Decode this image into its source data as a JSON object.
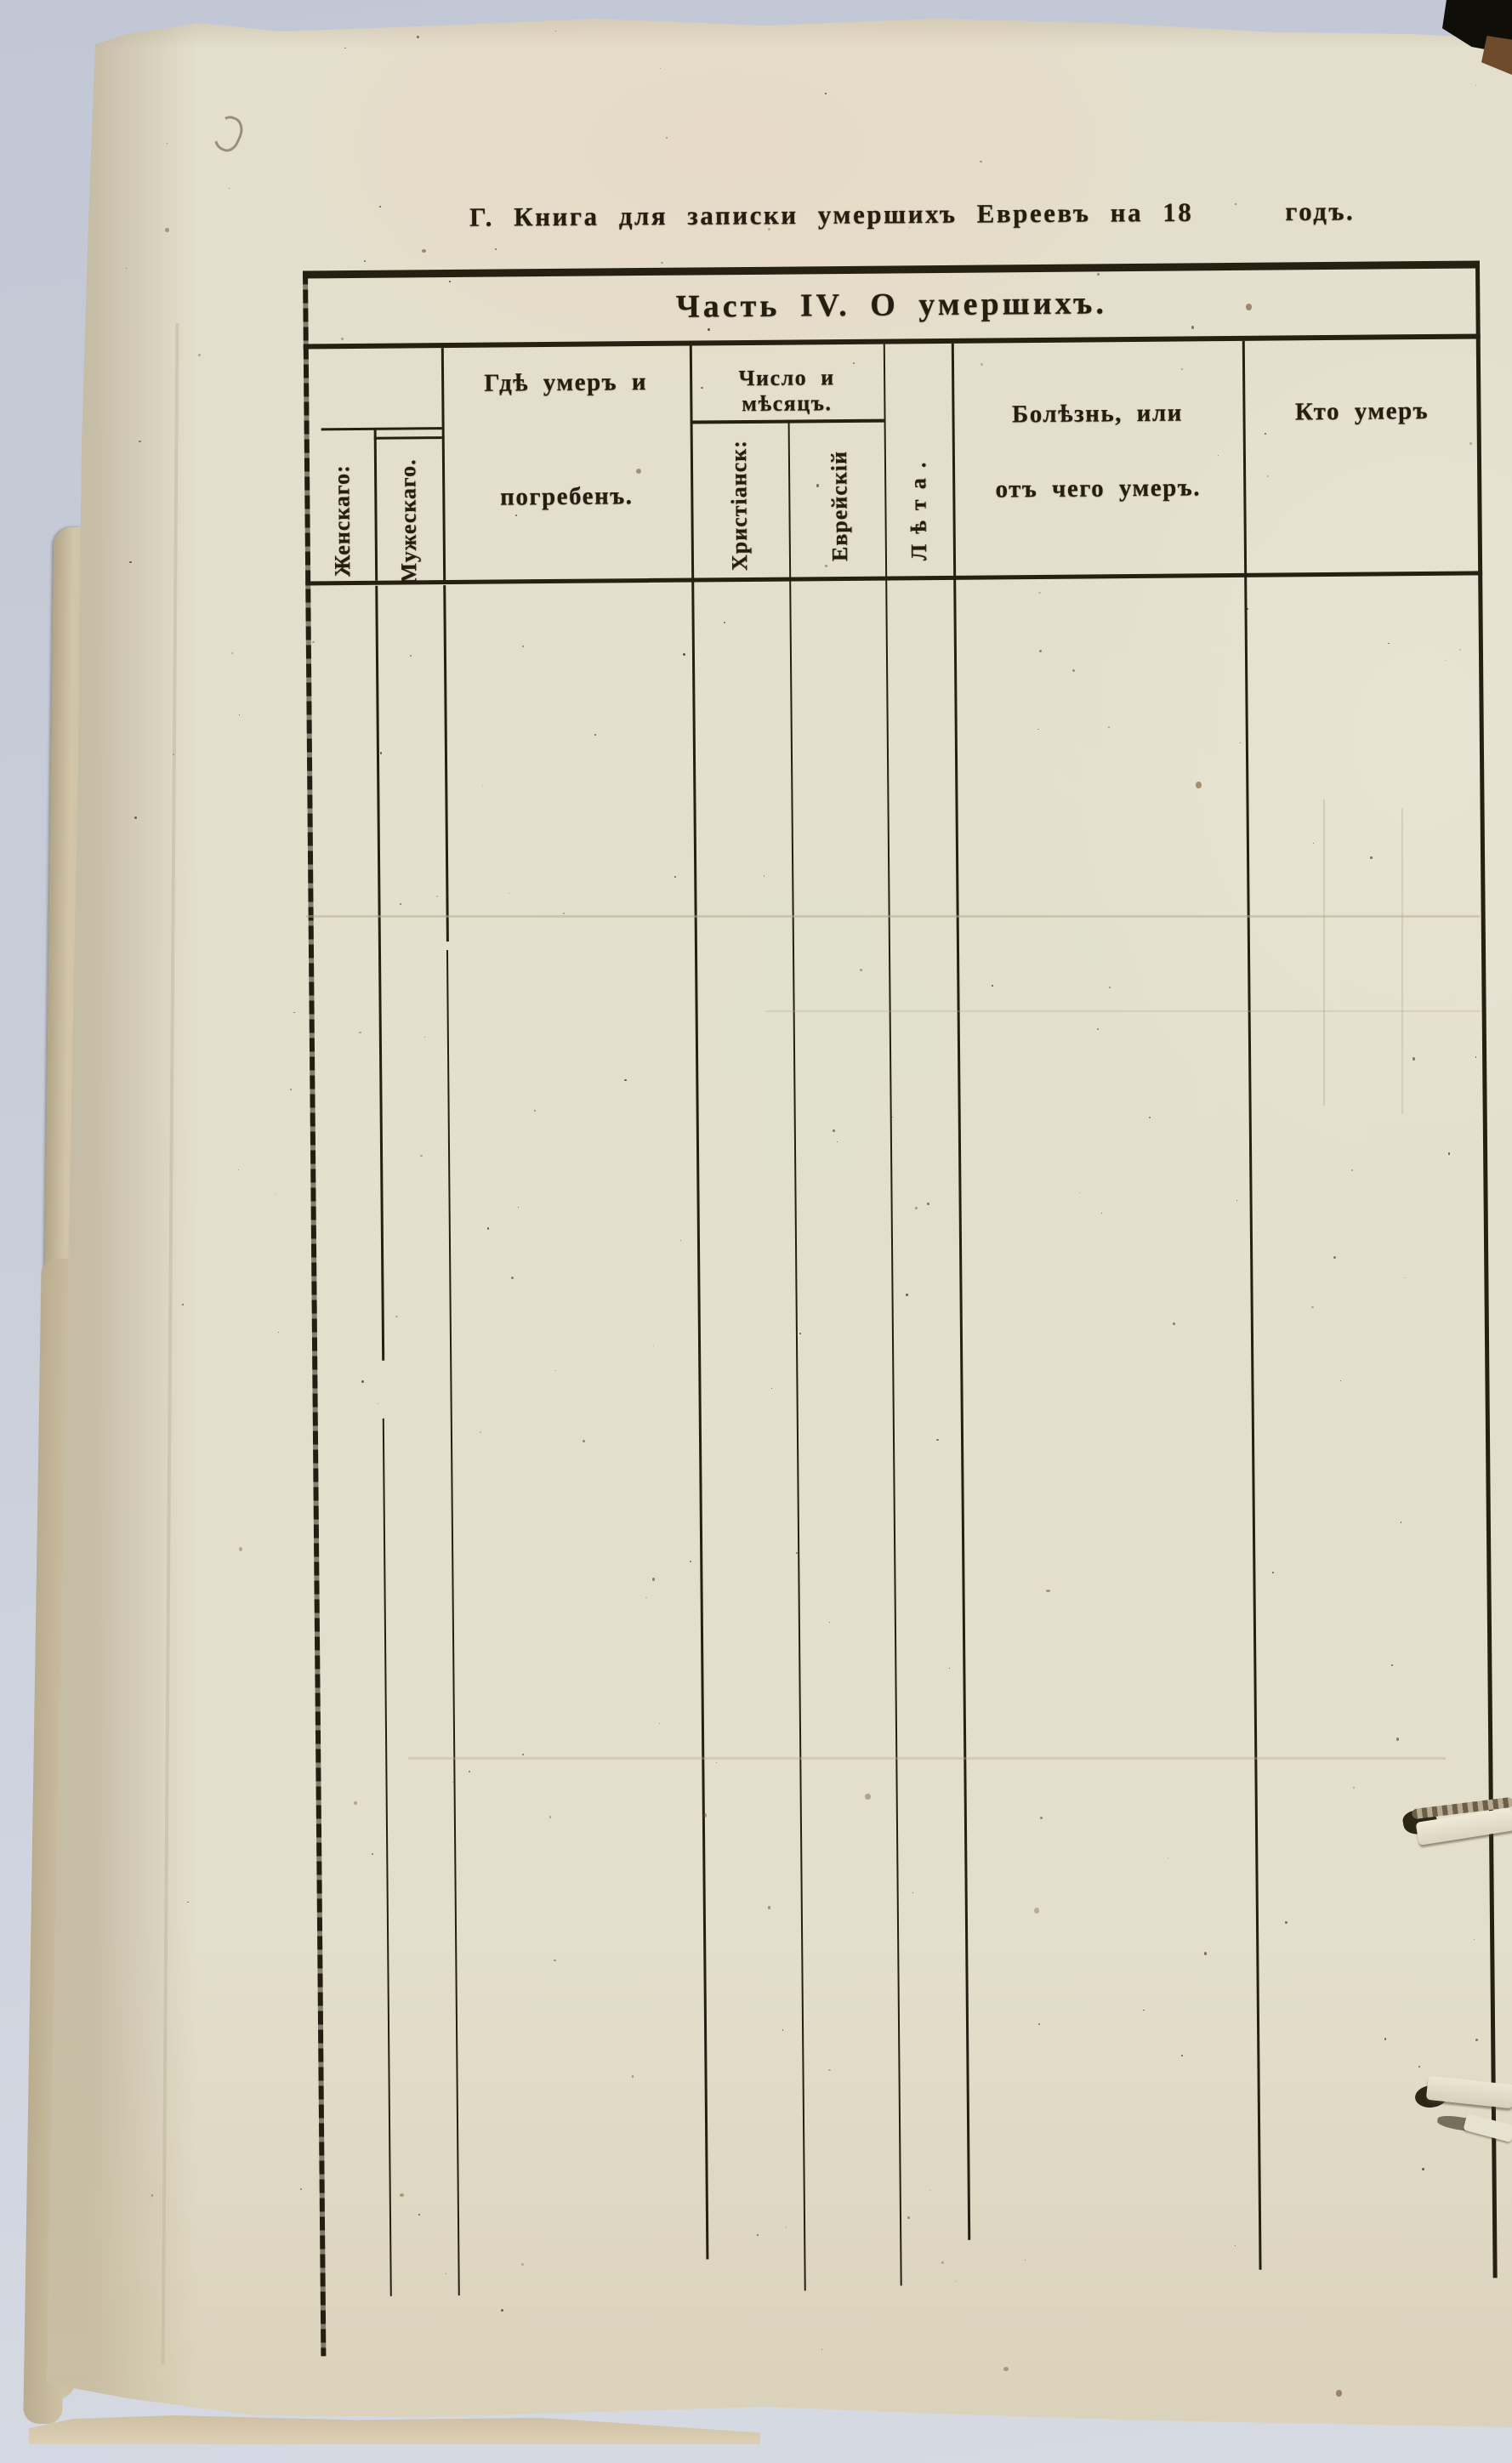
{
  "page": {
    "title": {
      "left": "Г. Книга для записки умершихъ Евреевъ на 18",
      "right": "годъ."
    },
    "table": {
      "section_title": "Часть IV. О умершихъ.",
      "columns": {
        "female": "Женскаго:",
        "male": "Мужескаго.",
        "where_died": {
          "line1": "Гдѣ умеръ и",
          "line2": "погребенъ."
        },
        "date_group": "Число и мѣсяцъ.",
        "christian": "Христіанск:",
        "jewish": "Еврейскій",
        "age": "Лѣта.",
        "illness": {
          "line1": "Болѣзнь, или",
          "line2": "отъ чего умеръ."
        },
        "who_died": "Кто умеръ"
      }
    }
  },
  "colors": {
    "ink": "#241d10",
    "table_line": "#262013",
    "paper": "#e4dfcd",
    "scanner_background": "#c9ced9"
  }
}
